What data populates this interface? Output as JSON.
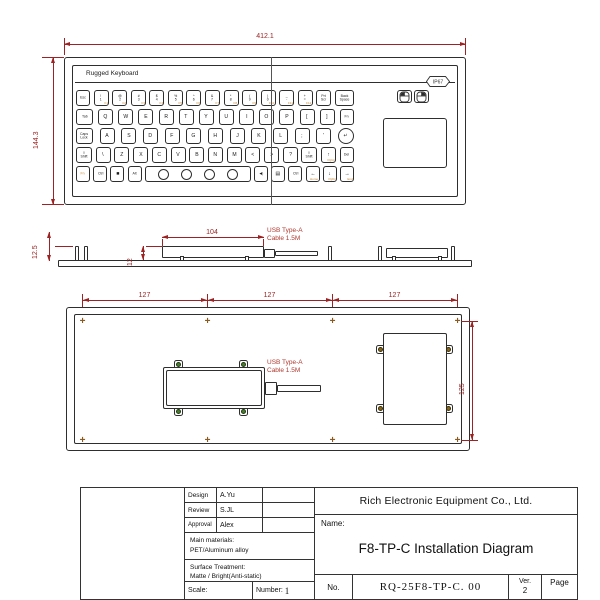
{
  "drawing": {
    "top_view": {
      "width_dim": "412.1",
      "height_dim": "144.3",
      "brand": "Rugged Keyboard",
      "ip_rating": "IP67"
    },
    "side_view": {
      "stud_height_dim": "12.5",
      "box_width_dim": "104",
      "box_height_dim": "12",
      "cable_label_line1": "USB Type-A",
      "cable_label_line2": "Cable 1.5M"
    },
    "back_view": {
      "hole_spacing_dims": [
        "127",
        "127",
        "127"
      ],
      "height_dim": "125",
      "cable_label_line1": "USB Type-A",
      "cable_label_line2": "Cable 1.5M"
    },
    "icons": {
      "mounting_hole_glyph": "+"
    },
    "colors": {
      "outline": "#2e2e2e",
      "dimension": "#9c2323",
      "fn_legend": "#c8842a",
      "screw_green": "#4a7d2f",
      "screw_gold": "#8a6a1a"
    }
  },
  "keyboard": {
    "rows": [
      [
        {
          "t": "Esc",
          "w": 14
        },
        {
          "t": "!\n1",
          "sub": "F1"
        },
        {
          "t": "@\n2",
          "sub": "F2"
        },
        {
          "t": "#\n3",
          "sub": "F3"
        },
        {
          "t": "$\n4",
          "sub": "F4"
        },
        {
          "t": "%\n5",
          "sub": "F5"
        },
        {
          "t": "^\n6",
          "sub": "F6"
        },
        {
          "t": "&\n7",
          "sub": "F7"
        },
        {
          "t": "*\n8",
          "sub": "F8"
        },
        {
          "t": "(\n9",
          "sub": "F9"
        },
        {
          "t": ")\n0",
          "sub": "F10"
        },
        {
          "t": "_\n-",
          "sub": "F11"
        },
        {
          "t": "+\n=",
          "sub": "F12"
        },
        {
          "t": "Prt\nScr"
        },
        {
          "t": "Back\nSpace",
          "w": 19
        }
      ],
      [
        {
          "t": "Tab",
          "w": 17
        },
        {
          "t": "Q"
        },
        {
          "t": "W"
        },
        {
          "t": "E"
        },
        {
          "t": "R"
        },
        {
          "t": "T"
        },
        {
          "t": "Y"
        },
        {
          "t": "U"
        },
        {
          "t": "I"
        },
        {
          "t": "O"
        },
        {
          "t": "P"
        },
        {
          "t": "["
        },
        {
          "t": "]"
        },
        {
          "t": "Fn",
          "w": 14
        }
      ],
      [
        {
          "t": "Caps\nLock",
          "w": 17
        },
        {
          "t": "A"
        },
        {
          "t": "S"
        },
        {
          "t": "D"
        },
        {
          "t": "F"
        },
        {
          "t": "G"
        },
        {
          "t": "H"
        },
        {
          "t": "J"
        },
        {
          "t": "K"
        },
        {
          "t": "L"
        },
        {
          "t": ";"
        },
        {
          "t": "'"
        },
        {
          "t": "↵",
          "type": "enter",
          "w": 16
        }
      ],
      [
        {
          "t": "⇧\nShift",
          "w": 16
        },
        {
          "t": "\\"
        },
        {
          "t": "Z"
        },
        {
          "t": "X"
        },
        {
          "t": "C"
        },
        {
          "t": "V"
        },
        {
          "t": "B"
        },
        {
          "t": "N"
        },
        {
          "t": "M"
        },
        {
          "t": "<"
        },
        {
          "t": ">"
        },
        {
          "t": "?"
        },
        {
          "t": "⇧\nShift",
          "w": 16
        },
        {
          "t": "↑",
          "sub": "PgUp"
        },
        {
          "t": "Del",
          "w": 14
        }
      ],
      [
        {
          "t": "Fn",
          "w": 14,
          "cls": "orange"
        },
        {
          "t": "Ctrl",
          "w": 14
        },
        {
          "t": "■",
          "w": 14
        },
        {
          "t": "Alt",
          "w": 14
        },
        {
          "type": "space",
          "w": 106
        },
        {
          "t": "◀)",
          "w": 14
        },
        {
          "t": "▤",
          "w": 14
        },
        {
          "t": "Ctrl",
          "w": 14
        },
        {
          "t": "←",
          "sub": "Home",
          "w": 14
        },
        {
          "t": "↓",
          "sub": "PgDn",
          "w": 14
        },
        {
          "t": "→",
          "sub": "End",
          "w": 14
        }
      ]
    ]
  },
  "title_block": {
    "design_label": "Design",
    "design_value": "A.Yu",
    "review_label": "Review",
    "review_value": "S.JL",
    "approval_label": "Approval",
    "approval_value": "Alex",
    "materials_label": "Main materials:",
    "materials_value": "PET/Aluminum alloy",
    "surface_label": "Surface Treatment:",
    "surface_value": "Matte / Bright(Anti-static)",
    "scale_label": "Scale:",
    "number_label": "Number:",
    "number_value": "1",
    "company": "Rich Electronic Equipment Co., Ltd.",
    "name_label": "Name:",
    "name_value": "F8-TP-C Installation Diagram",
    "no_label": "No.",
    "no_value": "RQ-25F8-TP-C. 00",
    "ver_label": "Ver.",
    "ver_value": "2",
    "page_label": "Page"
  }
}
